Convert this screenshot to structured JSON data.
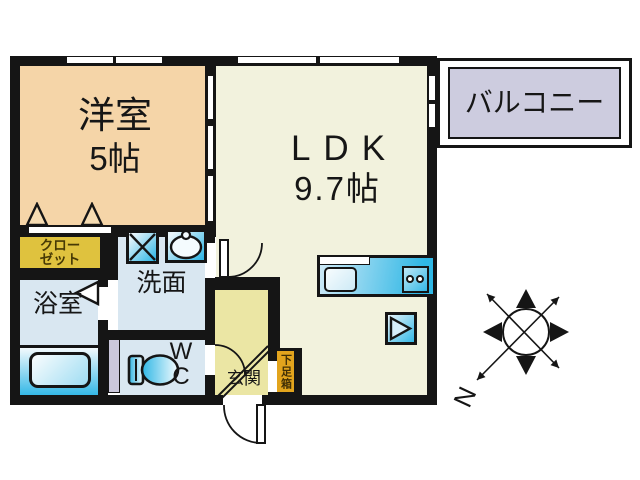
{
  "floor_plan": {
    "rooms": {
      "western_room": {
        "name": "洋室",
        "size": "5帖"
      },
      "ldk": {
        "name": "LDK",
        "size": "9.7帖"
      },
      "balcony": {
        "name": "バルコニー"
      },
      "closet": {
        "line1": "クロー",
        "line2": "ゼット"
      },
      "bathroom": {
        "name": "浴室"
      },
      "washroom": {
        "name": "洗面"
      },
      "toilet": {
        "line1": "W",
        "line2": "C"
      },
      "entrance": {
        "name": "玄関"
      },
      "shoe_box": {
        "name": "下足箱"
      }
    },
    "compass": {
      "north_label": "N"
    },
    "colors": {
      "wall": "#151515",
      "western_room_fill": "#f5d5a8",
      "ldk_fill": "#f2f2dd",
      "entrance_fill": "#ebe6a4",
      "closet_fill": "#dfc23e",
      "wet_room_fill": "#d9e7f1",
      "balcony_fill": "#cdccdf",
      "pipe_space_fill": "#cbc8dc",
      "shoe_box_fill": "#e2a41d",
      "fixture_cyan": "#2fb7e5"
    }
  }
}
